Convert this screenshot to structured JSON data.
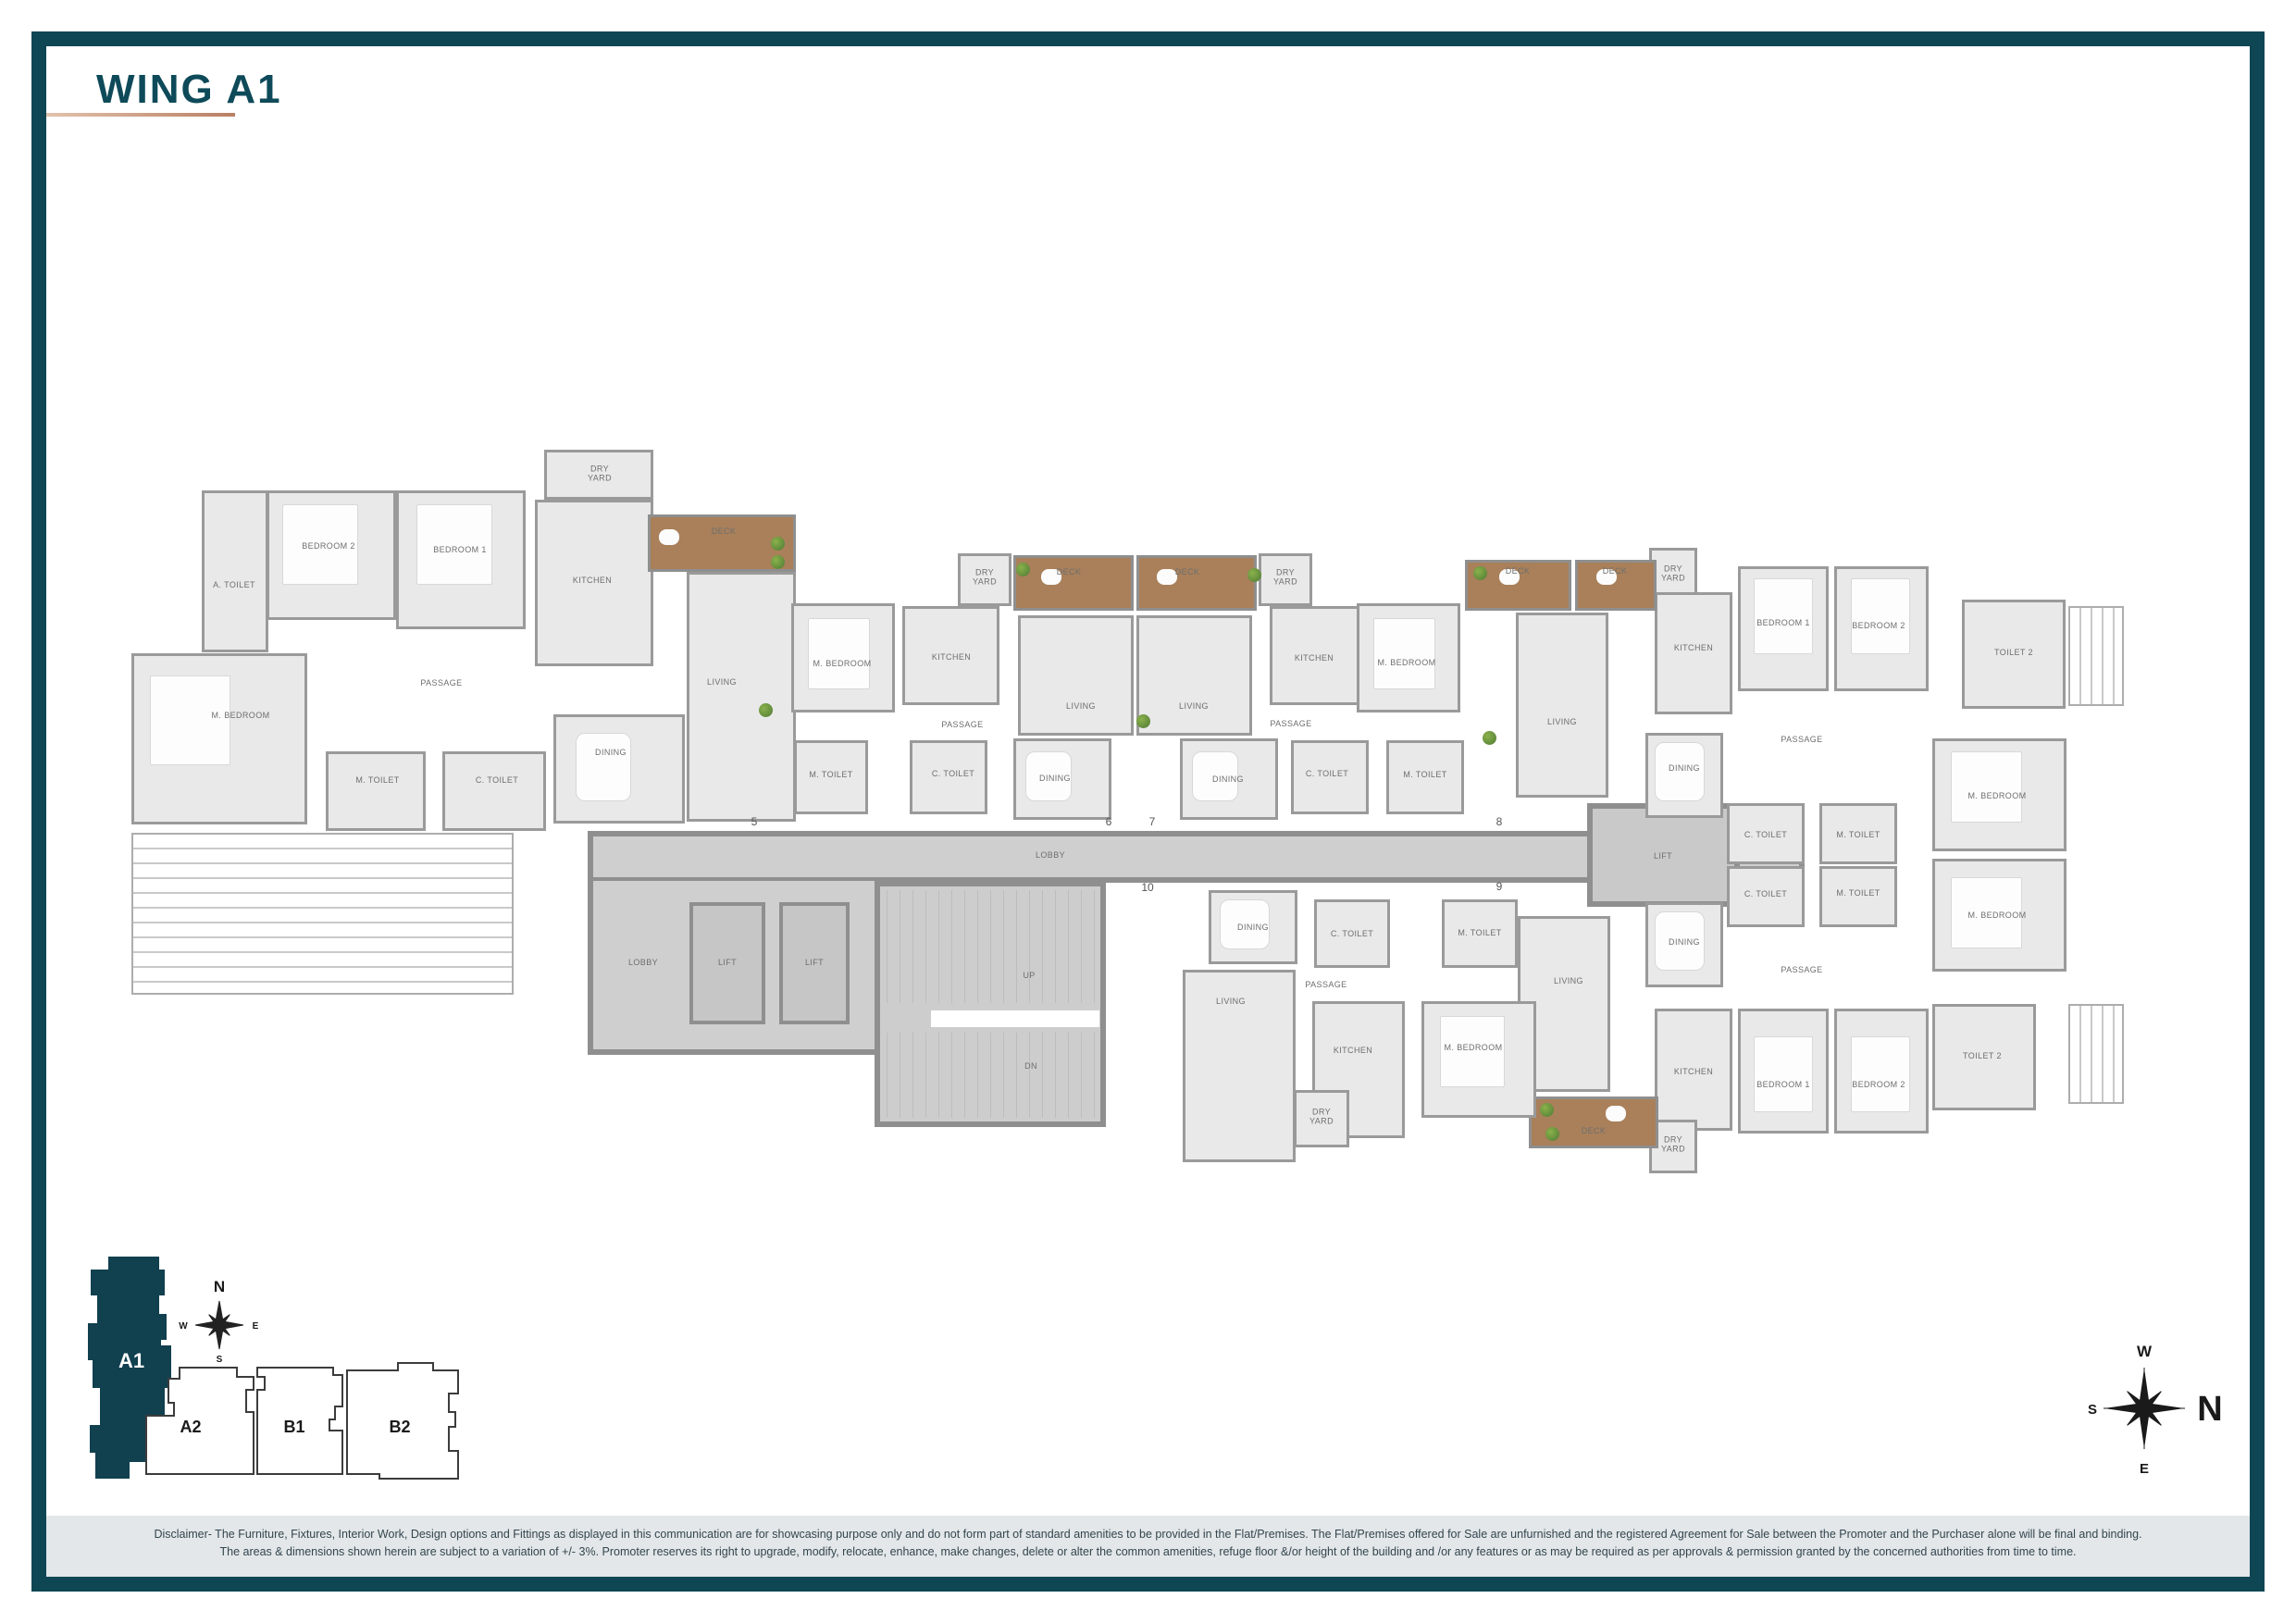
{
  "page": {
    "title": "WING A1",
    "colors": {
      "frame": "#0E4654",
      "title": "#0E4A59",
      "underline_start": "#E2C2AC",
      "underline_end": "#B97F63",
      "wall": "#8F8F8F",
      "floor": "#E9E9EA",
      "core": "#CFCFCF",
      "deck": "#A9805A",
      "keyplan_fill": "#11404F",
      "disclaimer_bg": "#E3E7E9",
      "plant": "#4E7A33"
    }
  },
  "plan": {
    "labels": {
      "living": "LIVING",
      "dining": "DINING",
      "kitchen": "KITCHEN",
      "passage": "PASSAGE",
      "m_bedroom": "M. BEDROOM",
      "bedroom_1": "BEDROOM 1",
      "bedroom_2": "BEDROOM 2",
      "m_toilet": "M. TOILET",
      "c_toilet": "C. TOILET",
      "a_toilet": "A. TOILET",
      "toilet_2": "TOILET 2",
      "dry_yard": "DRY YARD",
      "deck": "DECK",
      "lobby": "LOBBY",
      "lift": "LIFT",
      "up": "UP",
      "dn": "DN"
    },
    "unit_numbers": {
      "u5": "5",
      "u6": "6",
      "u7": "7",
      "u8": "8",
      "u9": "9",
      "u10": "10"
    }
  },
  "key_plan": {
    "wings": {
      "a1": "A1",
      "a2": "A2",
      "b1": "B1",
      "b2": "B2"
    },
    "compass": {
      "n": "N",
      "s": "S",
      "e": "E",
      "w": "W"
    }
  },
  "compass_main": {
    "n": "N",
    "s": "S",
    "e": "E",
    "w": "W"
  },
  "disclaimer": {
    "line1": "Disclaimer- The Furniture, Fixtures, Interior Work, Design options and Fittings as displayed in this communication are for showcasing purpose only and do not form part of standard amenities to be provided in the Flat/Premises. The Flat/Premises offered for Sale are unfurnished and the registered Agreement for Sale between the Promoter and the Purchaser alone will be final and binding.",
    "line2": "The areas & dimensions shown herein are subject to a variation of +/- 3%. Promoter reserves its right to upgrade, modify, relocate, enhance, make changes, delete or alter the common amenities, refuge floor &/or height of the building and /or any features or as may be required as per approvals & permission granted by the concerned authorities from time to time."
  }
}
